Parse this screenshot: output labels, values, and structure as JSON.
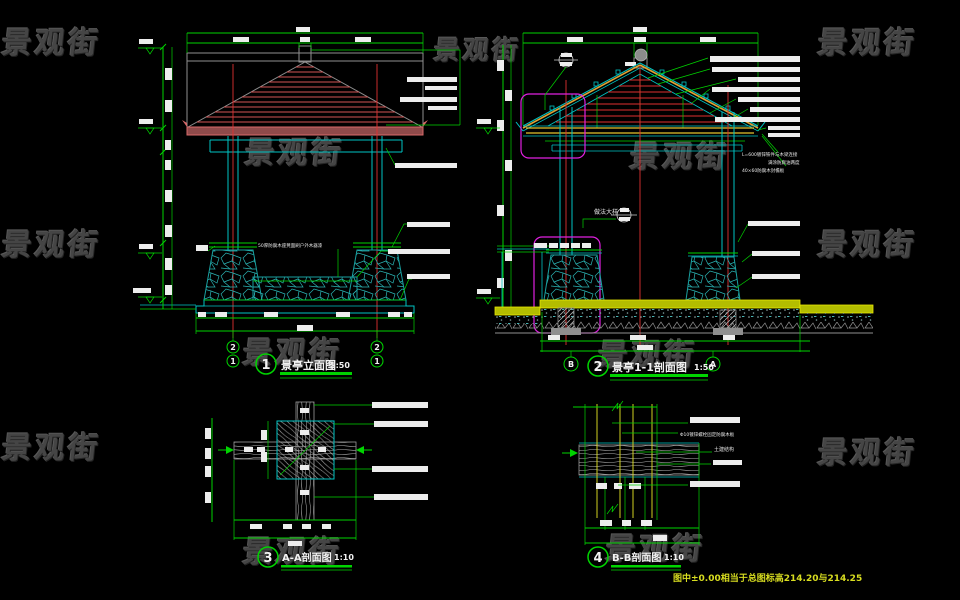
{
  "watermark": {
    "text": "景观街"
  },
  "sheet_note": {
    "text": "图中±0.00相当于总图标高214.20与214.25"
  },
  "views": [
    {
      "num": "1",
      "title": "景亭立面图",
      "scale": "1:50",
      "grid_bubbles": [
        "2",
        "1"
      ]
    },
    {
      "num": "2",
      "title": "景亭1-1剖面图",
      "scale": "1:50",
      "grid_bubbles": [
        "B",
        "A"
      ]
    },
    {
      "num": "3",
      "title": "A-A剖面图",
      "scale": "1:10"
    },
    {
      "num": "4",
      "title": "B-B剖面图",
      "scale": "1:10"
    }
  ],
  "callouts": {
    "detail_label": "做法大样",
    "bench_note": "50厚防腐木座凳面刷户外木器漆",
    "sec_note1": "L=600镀锌铁件与木梁连接",
    "sec_note2": "满涂防腐油两度",
    "sec_note3": "40×60防腐木封檐板",
    "bb_note1": "Φ10镀锌螺栓固定防腐木板",
    "bb_note2": "土建结构"
  },
  "colors": {
    "dimension": "#00d400",
    "structure_cyan": "#00c4c4",
    "centerline_red": "#e03030",
    "roof_red": "#d25555",
    "rafter_orange": "#e2a233",
    "ground_yellow": "#b3bd00",
    "detail_magenta": "#e020e0",
    "note_yellow": "#d8dd20"
  }
}
